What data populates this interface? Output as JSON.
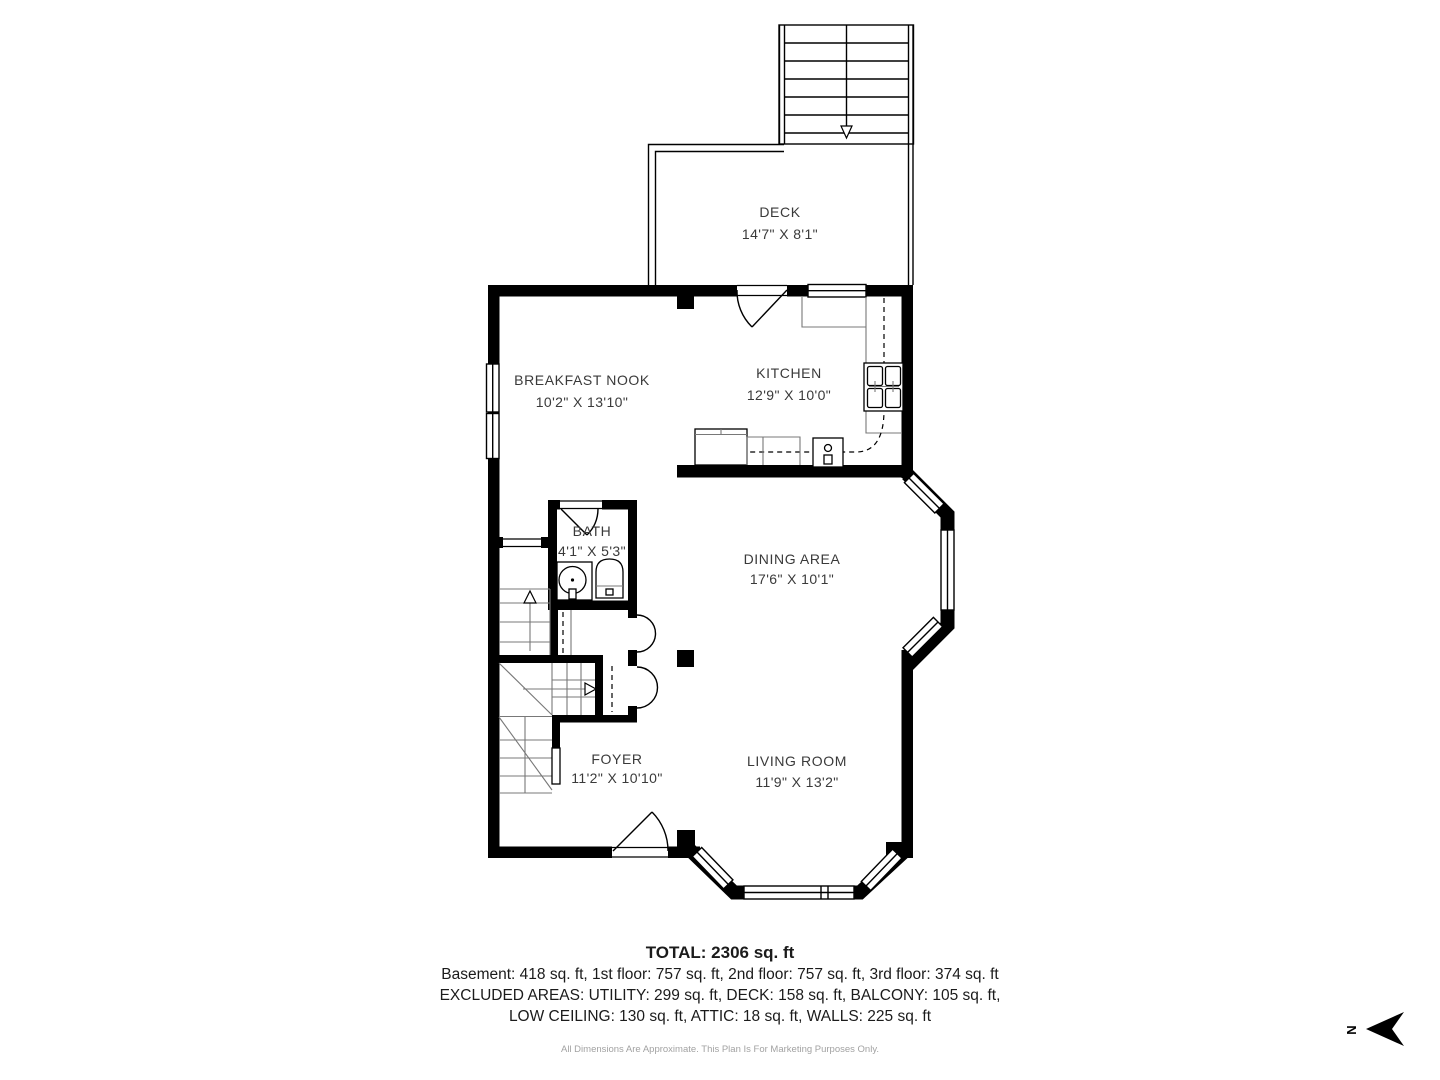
{
  "plan": {
    "rooms": [
      {
        "name": "DECK",
        "dims": "14'7\" X 8'1\""
      },
      {
        "name": "BREAKFAST NOOK",
        "dims": "10'2\" X 13'10\""
      },
      {
        "name": "KITCHEN",
        "dims": "12'9\" X 10'0\""
      },
      {
        "name": "BATH",
        "dims": "4'1\" X 5'3\""
      },
      {
        "name": "DINING AREA",
        "dims": "17'6\" X 10'1\""
      },
      {
        "name": "FOYER",
        "dims": "11'2\" X 10'10\""
      },
      {
        "name": "LIVING ROOM",
        "dims": "11'9\" X 13'2\""
      }
    ],
    "compass": {
      "label": "N"
    }
  },
  "summary": {
    "total": "TOTAL: 2306 sq. ft",
    "floors": "Basement: 418 sq. ft, 1st floor: 757 sq. ft, 2nd floor: 757 sq. ft, 3rd floor: 374 sq. ft",
    "excluded_line1": "EXCLUDED AREAS: UTILITY: 299 sq. ft, DECK: 158 sq. ft, BALCONY: 105 sq. ft,",
    "excluded_line2": "LOW CEILING: 130 sq. ft, ATTIC: 18 sq. ft, WALLS: 225 sq. ft",
    "disclaimer": "All Dimensions Are Approximate. This Plan Is For Marketing Purposes Only."
  },
  "colors": {
    "wall": "#000000",
    "room_text": "#3a3a3a",
    "summary_text": "#1b1b1b",
    "disclaimer_text": "#a2a2a2",
    "background": "#ffffff"
  }
}
